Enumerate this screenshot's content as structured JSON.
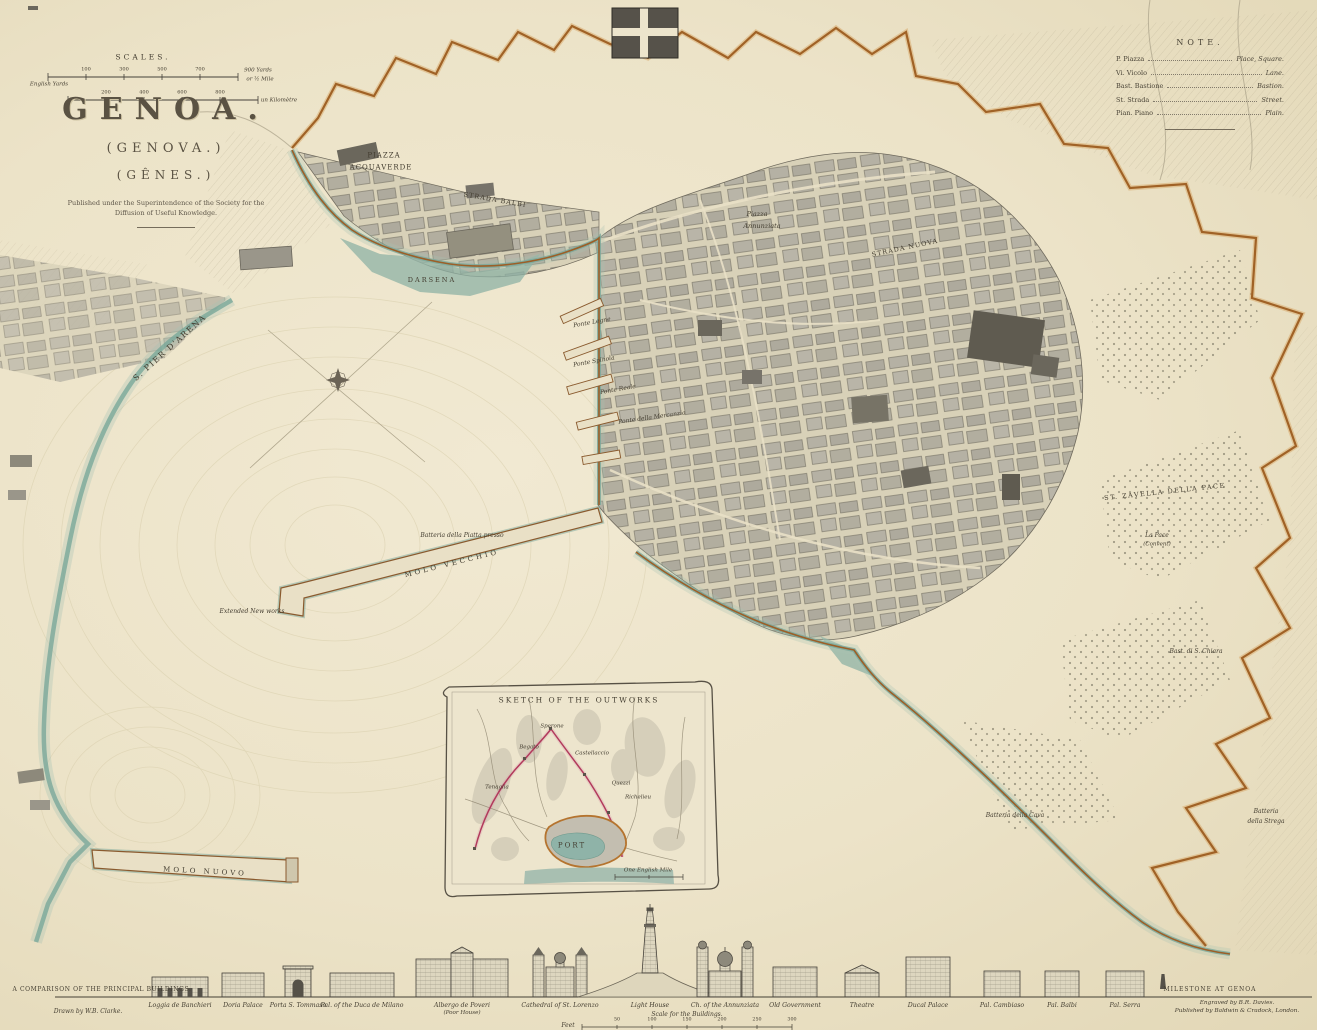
{
  "palette": {
    "paper": "#ece3c8",
    "ink": "#45413a",
    "water_teal": "#79a79a",
    "wall_orange": "#a06226",
    "city_block_gray": "#b5b1a4",
    "outwork_red": "#b23a5c"
  },
  "title_block": {
    "title": "GENOA.",
    "subtitle1": "(GENOVA.)",
    "subtitle2": "(GÊNES.)",
    "imprint1": "Published under the Superintendence of the Society for the",
    "imprint2": "Diffusion of Useful Knowledge."
  },
  "scales": {
    "heading": "SCALES.",
    "bar1": {
      "left_label": "English Yards",
      "ticks": [
        "100",
        "300",
        "500",
        "700"
      ],
      "right_label": "900 Yards",
      "right_label2": "or ½ Mile"
    },
    "bar2": {
      "ticks": [
        "200",
        "400",
        "600",
        "800"
      ],
      "right_label": "un Kilomètre"
    }
  },
  "note": {
    "heading": "NOTE.",
    "rows": [
      {
        "abbr": "P. Piazza",
        "meaning": "Place, Square."
      },
      {
        "abbr": "Vi. Vicolo",
        "meaning": "Lane."
      },
      {
        "abbr": "Bast. Bastione",
        "meaning": "Bastion."
      },
      {
        "abbr": "St. Strada",
        "meaning": "Street."
      },
      {
        "abbr": "Pian. Piano",
        "meaning": "Plain."
      }
    ]
  },
  "map_labels": [
    {
      "text": "S. PIER D'ARENA",
      "x": 170,
      "y": 348,
      "s": 8,
      "r": -42,
      "ls": 1.5
    },
    {
      "text": "PIAZZA",
      "x": 384,
      "y": 156,
      "s": 7,
      "ls": 1
    },
    {
      "text": "ACQUAVERDE",
      "x": 381,
      "y": 168,
      "s": 7,
      "ls": 1
    },
    {
      "text": "STRADA BALBI",
      "x": 495,
      "y": 200,
      "s": 6.5,
      "r": 10,
      "ls": 1
    },
    {
      "text": "Piazza",
      "x": 757,
      "y": 214,
      "s": 6.5,
      "it": true
    },
    {
      "text": "Annunziata",
      "x": 762,
      "y": 226,
      "s": 6.5,
      "it": true
    },
    {
      "text": "STRADA NUOVA",
      "x": 905,
      "y": 248,
      "s": 6.5,
      "r": -12,
      "ls": 1
    },
    {
      "text": "DARSENA",
      "x": 432,
      "y": 280,
      "s": 6.5,
      "ls": 2
    },
    {
      "text": "Ponte Legne",
      "x": 592,
      "y": 323,
      "s": 6,
      "it": true,
      "r": -10
    },
    {
      "text": "Ponte Spinola",
      "x": 594,
      "y": 362,
      "s": 6,
      "it": true,
      "r": -10
    },
    {
      "text": "Ponte Reale",
      "x": 618,
      "y": 390,
      "s": 6,
      "it": true,
      "r": -10
    },
    {
      "text": "Ponte della Mercanzia",
      "x": 652,
      "y": 418,
      "s": 6,
      "it": true,
      "r": -8
    },
    {
      "text": "Batteria della Piatta presso",
      "x": 462,
      "y": 536,
      "s": 6,
      "it": true
    },
    {
      "text": "MOLO VECCHIO",
      "x": 452,
      "y": 564,
      "s": 7,
      "r": -14,
      "ls": 3
    },
    {
      "text": "Extended New works",
      "x": 252,
      "y": 612,
      "s": 6,
      "it": true
    },
    {
      "text": "MOLO NUOVO",
      "x": 205,
      "y": 872,
      "s": 7,
      "r": 3,
      "ls": 3
    },
    {
      "text": "ST. ZAVELLA DELLA PACE",
      "x": 1165,
      "y": 492,
      "s": 6.5,
      "ls": 1.5,
      "r": -6
    },
    {
      "text": "La Pace",
      "x": 1157,
      "y": 536,
      "s": 6,
      "it": true
    },
    {
      "text": "(Convent)",
      "x": 1157,
      "y": 545,
      "s": 5.5,
      "it": true
    },
    {
      "text": "Bast. di S. Chiara",
      "x": 1196,
      "y": 652,
      "s": 6,
      "it": true
    },
    {
      "text": "Batteria della Cava",
      "x": 1015,
      "y": 816,
      "s": 6,
      "it": true
    },
    {
      "text": "Batteria",
      "x": 1266,
      "y": 812,
      "s": 6,
      "it": true
    },
    {
      "text": "della Strega",
      "x": 1266,
      "y": 822,
      "s": 6,
      "it": true
    }
  ],
  "inset": {
    "title": "SKETCH OF THE OUTWORKS",
    "port_label": "PORT",
    "scale_label": "One English Mile",
    "labels": [
      {
        "text": "Sperone",
        "x": 552,
        "y": 727,
        "s": 5.5,
        "it": true
      },
      {
        "text": "Begato",
        "x": 529,
        "y": 748,
        "s": 5.5,
        "it": true
      },
      {
        "text": "Castellaccio",
        "x": 592,
        "y": 754,
        "s": 5.5,
        "it": true
      },
      {
        "text": "Tenaglia",
        "x": 497,
        "y": 788,
        "s": 5.5,
        "it": true
      },
      {
        "text": "Quezzi",
        "x": 621,
        "y": 784,
        "s": 5.5,
        "it": true
      },
      {
        "text": "Richelieu",
        "x": 638,
        "y": 798,
        "s": 5.5,
        "it": true
      }
    ]
  },
  "buildings_band": {
    "heading": "A COMPARISON OF THE PRINCIPAL BUILDINGS.",
    "milestone_label": "MILESTONE AT GENOA",
    "scale_title": "Scale for the Buildings.",
    "scale_unit": "Feet",
    "scale_ticks": [
      "50",
      "100",
      "150",
      "200",
      "250",
      "300"
    ],
    "credit_left": "Drawn by W.B. Clarke.",
    "credit_right1": "Engraved by B.R. Davies.",
    "credit_right2": "Published by Baldwin & Cradock, London.",
    "buildings": [
      {
        "name": "Loggia de Banchieri",
        "x": 180,
        "w": 56,
        "h": 20,
        "kind": "arcade"
      },
      {
        "name": "Doria Palace",
        "x": 243,
        "w": 42,
        "h": 24,
        "kind": "block"
      },
      {
        "name": "Porta S. Tommaso",
        "x": 298,
        "w": 26,
        "h": 28,
        "kind": "gate"
      },
      {
        "name": "Pal. of the Duca de Milano",
        "x": 362,
        "w": 64,
        "h": 24,
        "kind": "block"
      },
      {
        "name": "Albergo de Poveri",
        "name2": "(Poor House)",
        "x": 462,
        "w": 92,
        "h": 38,
        "kind": "bighouse"
      },
      {
        "name": "Cathedral of St. Lorenzo",
        "x": 560,
        "w": 56,
        "h": 42,
        "kind": "cathedral"
      },
      {
        "name": "Light House",
        "x": 650,
        "w": 144,
        "h": 92,
        "kind": "lighthouse"
      },
      {
        "name": "Ch. of the Annunziata",
        "x": 725,
        "w": 62,
        "h": 50,
        "kind": "church"
      },
      {
        "name": "Old Government",
        "x": 795,
        "w": 44,
        "h": 30,
        "kind": "block"
      },
      {
        "name": "Theatre",
        "x": 862,
        "w": 34,
        "h": 24,
        "kind": "theatre"
      },
      {
        "name": "Ducal Palace",
        "x": 928,
        "w": 44,
        "h": 40,
        "kind": "block"
      },
      {
        "name": "Pal. Cambiaso",
        "x": 1002,
        "w": 36,
        "h": 26,
        "kind": "block"
      },
      {
        "name": "Pal. Balbi",
        "x": 1062,
        "w": 34,
        "h": 26,
        "kind": "block"
      },
      {
        "name": "Pal. Serra",
        "x": 1125,
        "w": 38,
        "h": 26,
        "kind": "block"
      }
    ]
  }
}
